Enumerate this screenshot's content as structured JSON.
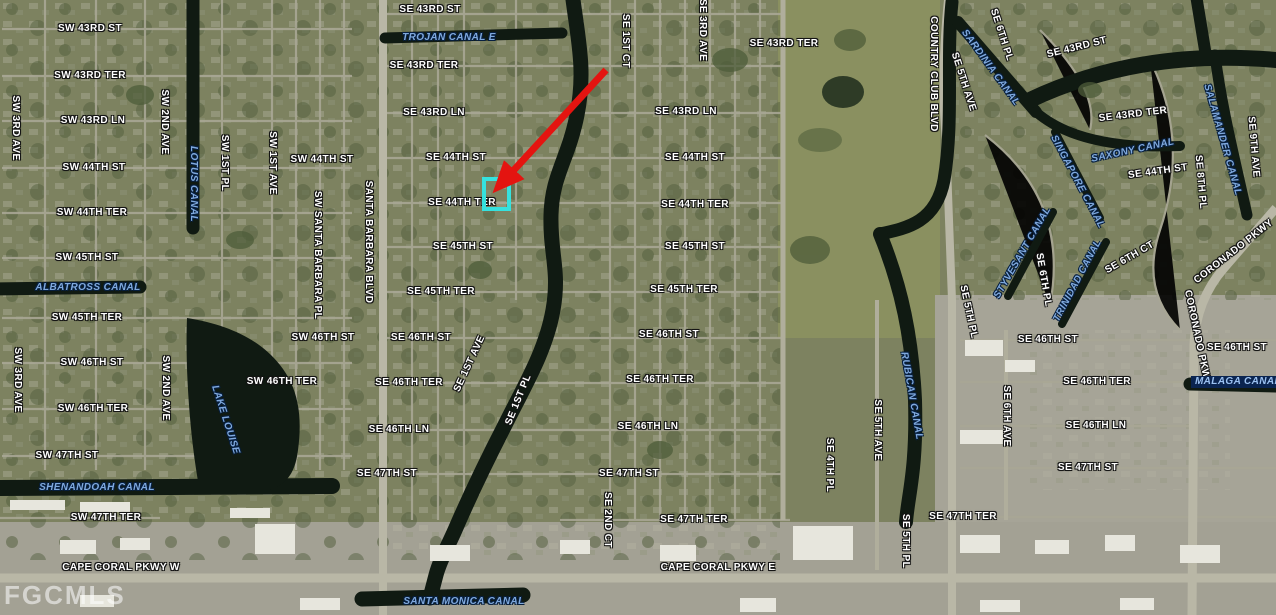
{
  "map": {
    "watermark": "FGCMLS",
    "colors": {
      "arrow": "#e41410",
      "highlight": "#35e2df",
      "street_label": "#ffffff",
      "canal_label": "#7fa9de",
      "water": "#101a12"
    },
    "annotation": {
      "arrow_from": {
        "x": 606,
        "y": 70
      },
      "arrow_to": {
        "x": 502,
        "y": 183
      },
      "highlight": {
        "x": 482,
        "y": 177,
        "w": 21,
        "h": 26
      }
    },
    "labels": [
      {
        "t": "SW 43RD ST",
        "x": 90,
        "y": 29,
        "r": 0,
        "k": "street"
      },
      {
        "t": "SW 43RD TER",
        "x": 90,
        "y": 76,
        "r": 0,
        "k": "street"
      },
      {
        "t": "SW 43RD LN",
        "x": 93,
        "y": 121,
        "r": 0,
        "k": "street"
      },
      {
        "t": "SW 44TH ST",
        "x": 94,
        "y": 168,
        "r": 0,
        "k": "street"
      },
      {
        "t": "SW 44TH TER",
        "x": 92,
        "y": 213,
        "r": 0,
        "k": "street"
      },
      {
        "t": "SW 45TH ST",
        "x": 87,
        "y": 258,
        "r": 0,
        "k": "street"
      },
      {
        "t": "SW 45TH TER",
        "x": 87,
        "y": 318,
        "r": 0,
        "k": "street"
      },
      {
        "t": "SW 46TH ST",
        "x": 92,
        "y": 363,
        "r": 0,
        "k": "street"
      },
      {
        "t": "SW 46TH TER",
        "x": 93,
        "y": 409,
        "r": 0,
        "k": "street"
      },
      {
        "t": "SW 47TH ST",
        "x": 67,
        "y": 456,
        "r": 0,
        "k": "street"
      },
      {
        "t": "SW 47TH TER",
        "x": 106,
        "y": 518,
        "r": 0,
        "k": "street"
      },
      {
        "t": "CAPE CORAL PKWY W",
        "x": 121,
        "y": 568,
        "r": 0,
        "k": "street"
      },
      {
        "t": "SW 3RD AVE",
        "x": 15,
        "y": 128,
        "r": 90,
        "k": "street"
      },
      {
        "t": "SW 3RD AVE",
        "x": 17,
        "y": 380,
        "r": 90,
        "k": "street"
      },
      {
        "t": "SW 2ND AVE",
        "x": 164,
        "y": 122,
        "r": 90,
        "k": "street"
      },
      {
        "t": "SW 2ND AVE",
        "x": 165,
        "y": 388,
        "r": 90,
        "k": "street"
      },
      {
        "t": "SW 1ST PL",
        "x": 224,
        "y": 163,
        "r": 90,
        "k": "street"
      },
      {
        "t": "SW 1ST AVE",
        "x": 272,
        "y": 163,
        "r": 90,
        "k": "street"
      },
      {
        "t": "SW 44TH ST",
        "x": 322,
        "y": 160,
        "r": 0,
        "k": "street"
      },
      {
        "t": "SW 46TH ST",
        "x": 323,
        "y": 338,
        "r": 0,
        "k": "street"
      },
      {
        "t": "SW 46TH TER",
        "x": 282,
        "y": 382,
        "r": 0,
        "k": "street"
      },
      {
        "t": "SW SANTA BARBARA PL",
        "x": 317,
        "y": 255,
        "r": 90,
        "k": "street"
      },
      {
        "t": "SANTA BARBARA BLVD",
        "x": 368,
        "y": 242,
        "r": 90,
        "k": "street"
      },
      {
        "t": "SE 43RD ST",
        "x": 430,
        "y": 10,
        "r": 0,
        "k": "street"
      },
      {
        "t": "SE 43RD TER",
        "x": 424,
        "y": 66,
        "r": 0,
        "k": "street"
      },
      {
        "t": "SE 43RD LN",
        "x": 434,
        "y": 113,
        "r": 0,
        "k": "street"
      },
      {
        "t": "SE 44TH ST",
        "x": 456,
        "y": 158,
        "r": 0,
        "k": "street"
      },
      {
        "t": "SE 44TH TER",
        "x": 462,
        "y": 203,
        "r": 0,
        "k": "street"
      },
      {
        "t": "SE 45TH ST",
        "x": 463,
        "y": 247,
        "r": 0,
        "k": "street"
      },
      {
        "t": "SE 45TH TER",
        "x": 441,
        "y": 292,
        "r": 0,
        "k": "street"
      },
      {
        "t": "SE 46TH ST",
        "x": 421,
        "y": 338,
        "r": 0,
        "k": "street"
      },
      {
        "t": "SE 46TH TER",
        "x": 409,
        "y": 383,
        "r": 0,
        "k": "street"
      },
      {
        "t": "SE 46TH LN",
        "x": 399,
        "y": 430,
        "r": 0,
        "k": "street"
      },
      {
        "t": "SE 47TH ST",
        "x": 387,
        "y": 474,
        "r": 0,
        "k": "street"
      },
      {
        "t": "SE 1ST CT",
        "x": 625,
        "y": 41,
        "r": 90,
        "k": "street"
      },
      {
        "t": "SE 3RD AVE",
        "x": 702,
        "y": 30,
        "r": 90,
        "k": "street"
      },
      {
        "t": "SE 1ST AVE",
        "x": 470,
        "y": 364,
        "r": -65,
        "k": "street"
      },
      {
        "t": "SE 1ST PL",
        "x": 519,
        "y": 400,
        "r": -68,
        "k": "street"
      },
      {
        "t": "SE 2ND CT",
        "x": 607,
        "y": 520,
        "r": 90,
        "k": "street"
      },
      {
        "t": "SE 43RD TER",
        "x": 784,
        "y": 44,
        "r": 0,
        "k": "street"
      },
      {
        "t": "SE 43RD LN",
        "x": 686,
        "y": 112,
        "r": 0,
        "k": "street"
      },
      {
        "t": "SE 44TH ST",
        "x": 695,
        "y": 158,
        "r": 0,
        "k": "street"
      },
      {
        "t": "SE 44TH TER",
        "x": 695,
        "y": 205,
        "r": 0,
        "k": "street"
      },
      {
        "t": "SE 45TH ST",
        "x": 695,
        "y": 247,
        "r": 0,
        "k": "street"
      },
      {
        "t": "SE 45TH TER",
        "x": 684,
        "y": 290,
        "r": 0,
        "k": "street"
      },
      {
        "t": "SE 46TH ST",
        "x": 669,
        "y": 335,
        "r": 0,
        "k": "street"
      },
      {
        "t": "SE 46TH TER",
        "x": 660,
        "y": 380,
        "r": 0,
        "k": "street"
      },
      {
        "t": "SE 46TH LN",
        "x": 648,
        "y": 427,
        "r": 0,
        "k": "street"
      },
      {
        "t": "SE 47TH ST",
        "x": 629,
        "y": 474,
        "r": 0,
        "k": "street"
      },
      {
        "t": "SE 47TH TER",
        "x": 694,
        "y": 520,
        "r": 0,
        "k": "street"
      },
      {
        "t": "CAPE CORAL PKWY E",
        "x": 718,
        "y": 568,
        "r": 0,
        "k": "street"
      },
      {
        "t": "SE 4TH PL",
        "x": 829,
        "y": 465,
        "r": 90,
        "k": "street"
      },
      {
        "t": "SE 5TH AVE",
        "x": 877,
        "y": 430,
        "r": 90,
        "k": "street"
      },
      {
        "t": "SE 5TH PL",
        "x": 905,
        "y": 541,
        "r": 90,
        "k": "street"
      },
      {
        "t": "SE 47TH TER",
        "x": 963,
        "y": 517,
        "r": 0,
        "k": "street"
      },
      {
        "t": "COUNTRY CLUB BLVD",
        "x": 933,
        "y": 74,
        "r": 90,
        "k": "street"
      },
      {
        "t": "SE 5TH AVE",
        "x": 963,
        "y": 82,
        "r": 72,
        "k": "street"
      },
      {
        "t": "SE 6TH PL",
        "x": 1001,
        "y": 35,
        "r": 72,
        "k": "street"
      },
      {
        "t": "SE 5TH PL",
        "x": 968,
        "y": 312,
        "r": 78,
        "k": "street"
      },
      {
        "t": "SE 6TH PL",
        "x": 1043,
        "y": 280,
        "r": 80,
        "k": "street"
      },
      {
        "t": "SE 6TH CT",
        "x": 1130,
        "y": 258,
        "r": -30,
        "k": "street"
      },
      {
        "t": "SE 6TH AVE",
        "x": 1006,
        "y": 416,
        "r": 90,
        "k": "street"
      },
      {
        "t": "SE 43RD ST",
        "x": 1077,
        "y": 48,
        "r": -14,
        "k": "street"
      },
      {
        "t": "SE 43RD TER",
        "x": 1133,
        "y": 115,
        "r": -7,
        "k": "street"
      },
      {
        "t": "SE 44TH ST",
        "x": 1158,
        "y": 172,
        "r": -8,
        "k": "street"
      },
      {
        "t": "SE 8TH PL",
        "x": 1200,
        "y": 182,
        "r": 85,
        "k": "street"
      },
      {
        "t": "SE 9TH AVE",
        "x": 1253,
        "y": 147,
        "r": 85,
        "k": "street"
      },
      {
        "t": "CORONADO PKWY",
        "x": 1234,
        "y": 252,
        "r": -38,
        "k": "street"
      },
      {
        "t": "CORONADO PKWY",
        "x": 1197,
        "y": 338,
        "r": 78,
        "k": "street"
      },
      {
        "t": "SE 46TH ST",
        "x": 1048,
        "y": 340,
        "r": 0,
        "k": "street"
      },
      {
        "t": "SE 46TH TER",
        "x": 1097,
        "y": 382,
        "r": 0,
        "k": "street"
      },
      {
        "t": "SE 46TH LN",
        "x": 1096,
        "y": 426,
        "r": 0,
        "k": "street"
      },
      {
        "t": "SE 47TH ST",
        "x": 1088,
        "y": 468,
        "r": 0,
        "k": "street"
      },
      {
        "t": "SE 46TH ST",
        "x": 1237,
        "y": 348,
        "r": 0,
        "k": "street"
      },
      {
        "t": "TROJAN CANAL E",
        "x": 449,
        "y": 38,
        "r": 0,
        "k": "canal"
      },
      {
        "t": "LOTUS CANAL",
        "x": 193,
        "y": 184,
        "r": 90,
        "k": "canal"
      },
      {
        "t": "ALBATROSS CANAL",
        "x": 88,
        "y": 288,
        "r": 0,
        "k": "canal"
      },
      {
        "t": "LAKE LOUISE",
        "x": 225,
        "y": 420,
        "r": 72,
        "k": "canal"
      },
      {
        "t": "SHENANDOAH CANAL",
        "x": 97,
        "y": 488,
        "r": 0,
        "k": "canal"
      },
      {
        "t": "SANTA MONICA CANAL",
        "x": 464,
        "y": 602,
        "r": 0,
        "k": "canal"
      },
      {
        "t": "SARDINIA CANAL",
        "x": 990,
        "y": 68,
        "r": 54,
        "k": "canal"
      },
      {
        "t": "SAXONY CANAL",
        "x": 1133,
        "y": 151,
        "r": -12,
        "k": "canal"
      },
      {
        "t": "SINGAPORE CANAL",
        "x": 1077,
        "y": 182,
        "r": 62,
        "k": "canal"
      },
      {
        "t": "SALAMANDER CANAL",
        "x": 1222,
        "y": 140,
        "r": 74,
        "k": "canal"
      },
      {
        "t": "STYVESANT CANAL",
        "x": 1023,
        "y": 253,
        "r": -60,
        "k": "canal"
      },
      {
        "t": "TRINIDAD CANAL",
        "x": 1078,
        "y": 281,
        "r": -62,
        "k": "canal"
      },
      {
        "t": "RUBICAN CANAL",
        "x": 911,
        "y": 396,
        "r": 80,
        "k": "canal"
      },
      {
        "t": "MALAGA CANAL",
        "x": 1238,
        "y": 382,
        "r": 0,
        "k": "canalbox"
      }
    ]
  }
}
